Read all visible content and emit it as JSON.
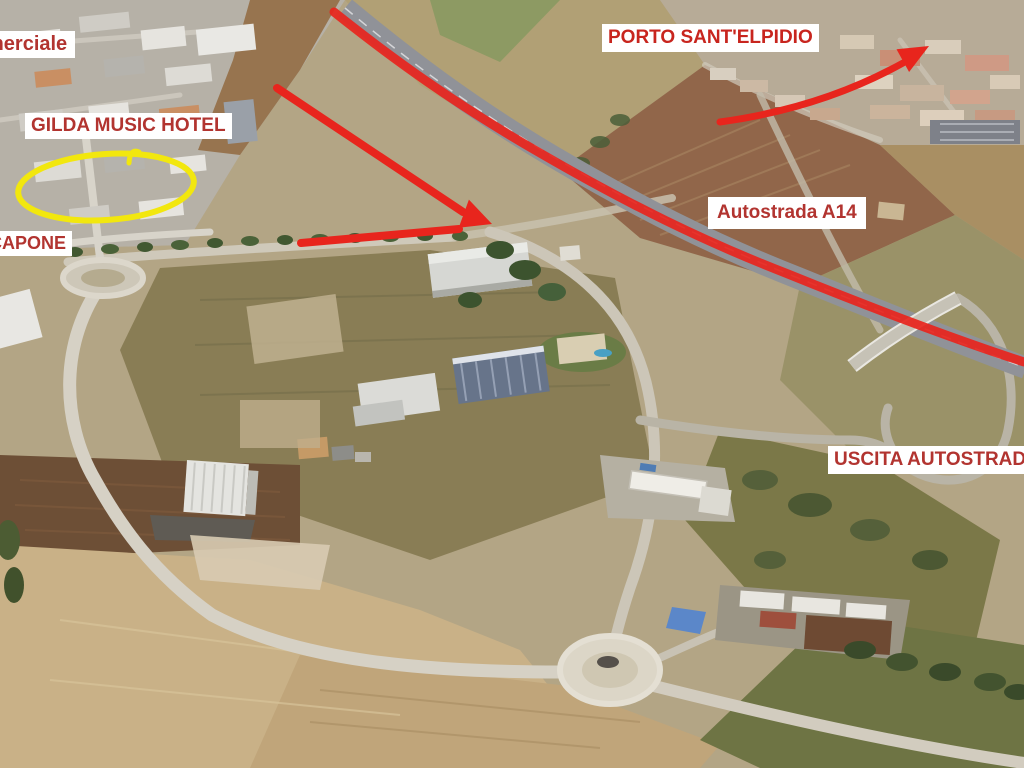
{
  "map_annotations": {
    "labels": {
      "commerciale_partial": "merciale",
      "gilda_music_hotel": "GILDA MUSIC HOTEL",
      "capone_partial": "CAPONE",
      "porto_sant_elpidio": "PORTO SANT'ELPIDIO",
      "autostrada_a14": "Autostrada A14",
      "uscita_autostrada": "USCITA AUTOSTRADA"
    },
    "colors": {
      "label_text_red": "#b23430",
      "label_text_bright_red": "#c8251e",
      "label_background": "#ffffff",
      "route_highlight_red": "#e8251d",
      "ellipse_highlight_yellow": "#f2e70e"
    },
    "icons": {
      "hotel-highlight-ellipse": "yellow-ellipse-outline",
      "route-arrow": "red-bent-arrow",
      "destination-arrow": "red-curved-arrow",
      "highway-route-line": "red-line"
    }
  }
}
